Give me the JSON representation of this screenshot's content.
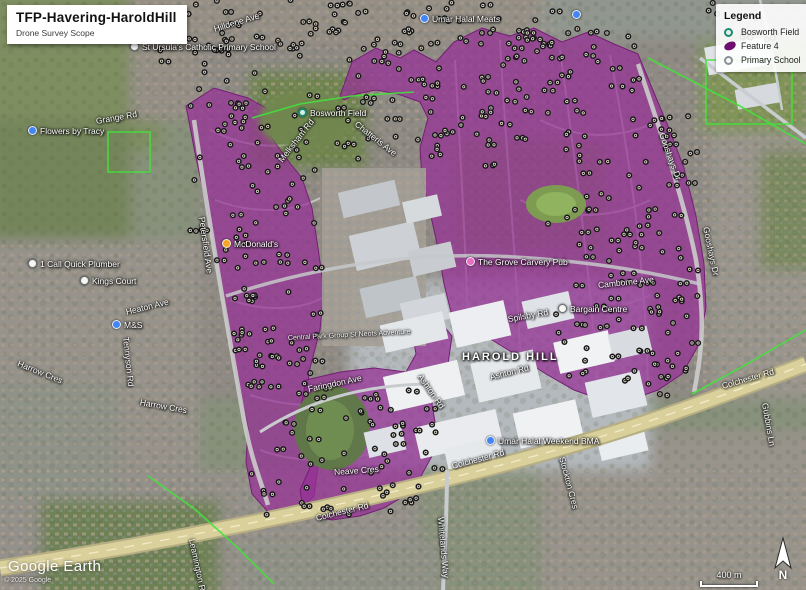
{
  "title_card": {
    "title": "TFP-Havering-HaroldHill",
    "subtitle": "Drone Survey Scope"
  },
  "legend": {
    "title": "Legend",
    "items": [
      {
        "label": "Bosworth Field",
        "icon": "teal-ring"
      },
      {
        "label": "Feature 4",
        "icon": "purple-polygon"
      },
      {
        "label": "Primary School",
        "icon": "gray-ring"
      }
    ]
  },
  "watermark": {
    "brand": "Google Earth",
    "copyright": "© 2025 Google"
  },
  "scale_bar": {
    "label": "400 m"
  },
  "compass": {
    "label": "N"
  },
  "map_labels": [
    {
      "text": "St Ursula's Catholic Primary School",
      "x": 130,
      "y": 42,
      "rot": 0,
      "kind": "poi-white"
    },
    {
      "text": "Hilldene Ave",
      "x": 214,
      "y": 24,
      "rot": -17,
      "kind": "street"
    },
    {
      "text": "Umar Halal Meats",
      "x": 420,
      "y": 14,
      "rot": 0,
      "kind": "poi-blue"
    },
    {
      "text": "",
      "x": 572,
      "y": 10,
      "rot": 0,
      "kind": "poi-blue"
    },
    {
      "text": "Grange Rd",
      "x": 96,
      "y": 116,
      "rot": -10,
      "kind": "street"
    },
    {
      "text": "Flowers by Tracy",
      "x": 28,
      "y": 126,
      "rot": 0,
      "kind": "poi-blue"
    },
    {
      "text": "Bosworth Field",
      "x": 298,
      "y": 108,
      "rot": 0,
      "kind": "poi-teal"
    },
    {
      "text": "Chatteris Ave",
      "x": 356,
      "y": 118,
      "rot": 38,
      "kind": "street"
    },
    {
      "text": "Melksham Rd",
      "x": 280,
      "y": 156,
      "rot": -52,
      "kind": "street"
    },
    {
      "text": "Gooshays Dr",
      "x": 662,
      "y": 128,
      "rot": 70,
      "kind": "street"
    },
    {
      "text": "Gooshays Dr",
      "x": 706,
      "y": 222,
      "rot": 78,
      "kind": "street"
    },
    {
      "text": "Petersfield Ave",
      "x": 202,
      "y": 212,
      "rot": 82,
      "kind": "street"
    },
    {
      "text": "McDonald's",
      "x": 222,
      "y": 239,
      "rot": 0,
      "kind": "poi-orange"
    },
    {
      "text": "1 Call Quick Plumber",
      "x": 28,
      "y": 259,
      "rot": 0,
      "kind": "poi-white"
    },
    {
      "text": "Kings Court",
      "x": 80,
      "y": 276,
      "rot": 0,
      "kind": "poi-white"
    },
    {
      "text": "Heaton Ave",
      "x": 126,
      "y": 307,
      "rot": -14,
      "kind": "street"
    },
    {
      "text": "M&S",
      "x": 112,
      "y": 320,
      "rot": 0,
      "kind": "poi-blue"
    },
    {
      "text": "Tennyson Rd",
      "x": 126,
      "y": 332,
      "rot": 84,
      "kind": "street"
    },
    {
      "text": "Harrow Cres",
      "x": 18,
      "y": 358,
      "rot": 22,
      "kind": "street"
    },
    {
      "text": "Harrow Cres",
      "x": 140,
      "y": 397,
      "rot": 10,
      "kind": "street"
    },
    {
      "text": "The Grove Carvery Pub",
      "x": 466,
      "y": 257,
      "rot": 0,
      "kind": "poi-pink"
    },
    {
      "text": "Camborne Ave",
      "x": 598,
      "y": 280,
      "rot": -6,
      "kind": "street"
    },
    {
      "text": "Spilsby Rd",
      "x": 508,
      "y": 314,
      "rot": -10,
      "kind": "street"
    },
    {
      "text": "Bargain Centre",
      "x": 558,
      "y": 304,
      "rot": 0,
      "kind": "poi-white"
    },
    {
      "text": "HAROLD HILL",
      "x": 462,
      "y": 352,
      "rot": 0,
      "kind": "area"
    },
    {
      "text": "Ashton Rd",
      "x": 490,
      "y": 372,
      "rot": -14,
      "kind": "street"
    },
    {
      "text": "Central Park Group St Neots Adventure",
      "x": 288,
      "y": 334,
      "rot": -3,
      "kind": "street-sm"
    },
    {
      "text": "Faringdon Ave",
      "x": 308,
      "y": 384,
      "rot": -12,
      "kind": "street"
    },
    {
      "text": "Ashton Rd",
      "x": 420,
      "y": 370,
      "rot": 55,
      "kind": "street"
    },
    {
      "text": "Neave Cres",
      "x": 334,
      "y": 467,
      "rot": -4,
      "kind": "street"
    },
    {
      "text": "Colchester Rd",
      "x": 452,
      "y": 461,
      "rot": -15,
      "kind": "street"
    },
    {
      "text": "Colchester Rd",
      "x": 316,
      "y": 513,
      "rot": -14,
      "kind": "street"
    },
    {
      "text": "Colchester Rd",
      "x": 722,
      "y": 381,
      "rot": -16,
      "kind": "street"
    },
    {
      "text": "Umar Halal Weekend BMA",
      "x": 486,
      "y": 436,
      "rot": 0,
      "kind": "poi-blue"
    },
    {
      "text": "Whitelands Way",
      "x": 441,
      "y": 512,
      "rot": 85,
      "kind": "street"
    },
    {
      "text": "Stockton Cres",
      "x": 562,
      "y": 452,
      "rot": 75,
      "kind": "street"
    },
    {
      "text": "Gubbins Ln",
      "x": 765,
      "y": 398,
      "rot": 80,
      "kind": "street"
    },
    {
      "text": "Leamington Rd",
      "x": 192,
      "y": 534,
      "rot": 78,
      "kind": "street"
    }
  ],
  "survey": {
    "feature_name": "Feature 4",
    "fill": "#952f95",
    "fill_opacity": 0.72,
    "stroke": "#741f74",
    "marker_ring": "#f1ead2",
    "marker_dark": "#17171a",
    "seed": 11,
    "polygons": [
      "186,106 214,88 248,98 266,108 272,138 286,158 302,178 312,208 318,248 324,290 320,330 310,368 304,408 308,444 318,466 314,496 294,514 268,512 252,494 246,462 248,428 240,390 232,350 226,308 218,262 208,212 196,158",
      "340,96 352,62 376,48 400,58 414,50 436,62 454,42 482,28 510,36 534,28 562,42 588,32 614,44 638,54 652,88 668,126 684,168 696,216 704,264 706,308 698,346 682,374 658,390 630,400 602,400 574,390 546,374 518,356 492,340 468,328 452,316 444,284 438,248 430,212 422,178 420,148 428,118 420,102 398,94 376,90 356,94 344,100",
      "306,380 340,372 374,368 406,372 416,354 412,332 422,318 442,324 452,336 448,364 438,382 432,404 436,428 432,456 420,478 404,496 384,508 360,516 332,520 304,514 300,490 310,468 306,440 300,412"
    ],
    "marker_regions": [
      [
        150,
        0,
        130,
        95,
        30
      ],
      [
        280,
        0,
        150,
        60,
        34
      ],
      [
        430,
        0,
        130,
        45,
        20
      ],
      [
        700,
        0,
        80,
        40,
        8
      ],
      [
        190,
        95,
        130,
        170,
        55
      ],
      [
        230,
        265,
        90,
        120,
        34
      ],
      [
        250,
        380,
        175,
        135,
        48
      ],
      [
        330,
        50,
        120,
        110,
        30
      ],
      [
        480,
        25,
        160,
        90,
        44
      ],
      [
        545,
        115,
        155,
        150,
        58
      ],
      [
        555,
        265,
        145,
        120,
        38
      ],
      [
        610,
        290,
        90,
        105,
        18
      ],
      [
        430,
        80,
        100,
        90,
        22
      ],
      [
        360,
        390,
        80,
        110,
        18
      ]
    ]
  }
}
